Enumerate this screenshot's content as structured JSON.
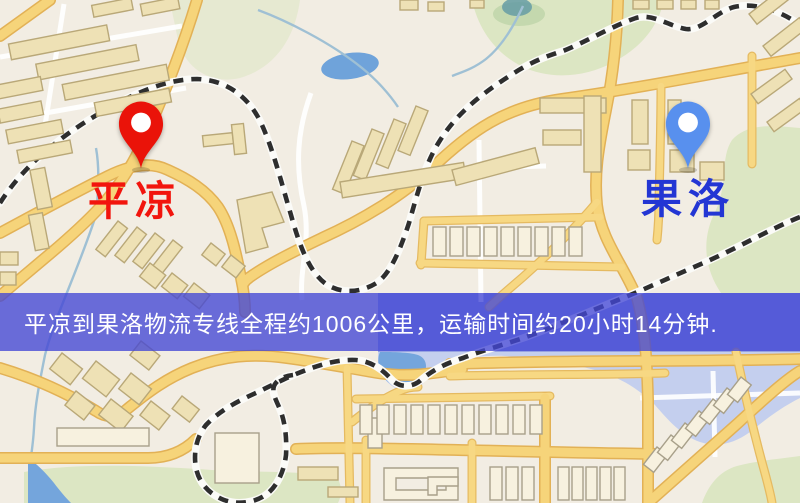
{
  "banner": {
    "text": "平凉到果洛物流专线全程约1006公里，运输时间约20小时14分钟.",
    "background_color": "rgba(66,71,213,0.78)",
    "text_color": "#ffffff"
  },
  "markers": {
    "origin": {
      "name": "平凉",
      "label_color": "#f2150d",
      "pin_color": "#ea1309"
    },
    "destination": {
      "name": "果洛",
      "label_color": "#2336d4",
      "pin_color": "#5890ee"
    }
  },
  "route": {
    "origin": "平凉",
    "destination": "果洛",
    "distance_text": "约1006公里",
    "duration_text": "约20小时14分钟"
  },
  "map_colors": {
    "background": "#f2ede3",
    "road_fill": "#f6d47a",
    "road_casing": "#e2b156",
    "water": "#74a5dc",
    "water_pale": "#c4cfee",
    "park": "#dce6c3",
    "railway": "#2e2e2e",
    "building": "#eee1b5"
  }
}
